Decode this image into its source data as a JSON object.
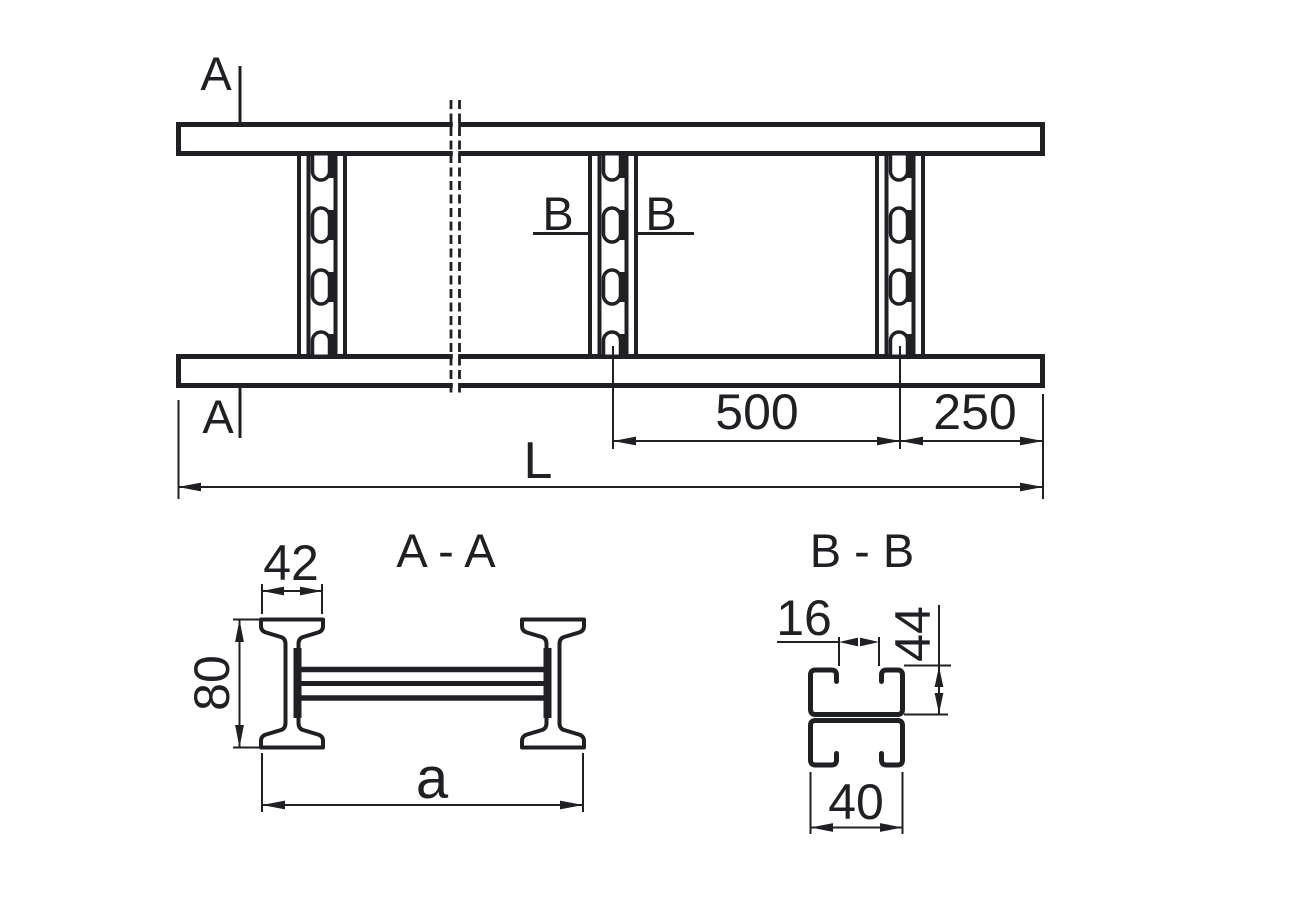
{
  "colors": {
    "line": "#1e2023",
    "background": "#ffffff"
  },
  "top_view": {
    "cut_label_a": "A",
    "cut_label_b": "B",
    "dim_rung_pitch": "500",
    "dim_end_distance": "250",
    "dim_overall_length": "L"
  },
  "section_a": {
    "title": "A - A",
    "dim_flange_width": "42",
    "dim_rail_height": "80",
    "dim_overall_width": "a"
  },
  "section_b": {
    "title": "B - B",
    "dim_lip_opening": "16",
    "dim_channel_height": "44",
    "dim_channel_width": "40"
  }
}
